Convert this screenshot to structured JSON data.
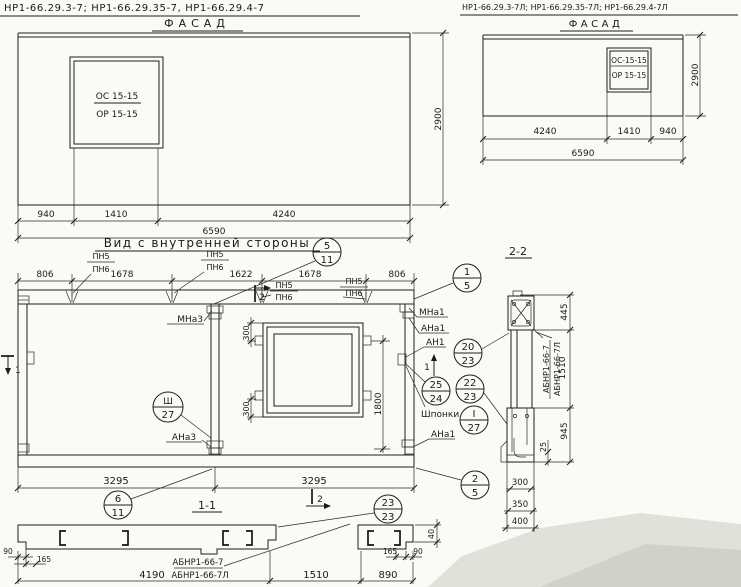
{
  "headers": {
    "left": "НР1-66.29.3-7;  НР1-66.29.35-7,  НР1-66.29.4-7",
    "right": "НР1-66.29.3-7Л; НР1-66.29.35-7Л; НР1-66.29.4-7Л"
  },
  "facade_left": {
    "title": "ФАСАД",
    "window": {
      "line1": "ОС 15-15",
      "line2": "ОР 15-15"
    },
    "dims": {
      "a": "940",
      "b": "1410",
      "c": "4240",
      "total": "6590",
      "height": "2900"
    }
  },
  "facade_right": {
    "title": "ФАСАД",
    "window": {
      "line1": "ОС-15-15",
      "line2": "ОР 15-15"
    },
    "dims": {
      "a": "4240",
      "b": "1410",
      "c": "940",
      "total": "6590",
      "height": "2900"
    }
  },
  "inner_view": {
    "title": "Вид с внутренней стороны",
    "top_dims": {
      "d1": "806",
      "d2": "1678",
      "d3": "1622",
      "d4": "1678",
      "d5": "806"
    },
    "pn": {
      "top": "ПН5",
      "bottom": "ПН6"
    },
    "labels": {
      "mna3": "МНа3",
      "mna1": "МНа1",
      "ana1": "АНа1",
      "an1": "АН1",
      "shponki": "Шпонки",
      "ana3": "АНа3",
      "ana1_bottom": "АНа1"
    },
    "window_dims": {
      "top": "300",
      "bottom": "300",
      "height": "1800"
    },
    "bottom_dims": {
      "left": "3295",
      "right": "3295"
    },
    "marks": {
      "m1": "1",
      "m2": "2"
    },
    "section_title": "1-1"
  },
  "callouts": {
    "c5_11": {
      "top": "5",
      "bottom": "11"
    },
    "c1_5": {
      "top": "1",
      "bottom": "5"
    },
    "c3_27": {
      "top": "Ш",
      "bottom": "27"
    },
    "c20_23": {
      "top": "20",
      "bottom": "23"
    },
    "c25_24": {
      "top": "25",
      "bottom": "24"
    },
    "c22_23": {
      "top": "22",
      "bottom": "23"
    },
    "cI_27": {
      "top": "I",
      "bottom": "27"
    },
    "c6_11": {
      "top": "6",
      "bottom": "11"
    },
    "c2_5": {
      "top": "2",
      "bottom": "5"
    },
    "c23_23": {
      "top": "23",
      "bottom": "23"
    }
  },
  "section22": {
    "title": "2-2",
    "labels": {
      "mark": "АБНР1-66-7",
      "markL": "АБНР1-66-7Л"
    },
    "dims": {
      "d445": "445",
      "d1510": "1510",
      "d25": "25",
      "d945": "945",
      "d300": "300",
      "d350": "350",
      "d400": "400"
    }
  },
  "section11": {
    "labels": {
      "mark": "АБНР1-66-7",
      "markL": "АБНР1-66-7Л"
    },
    "dims": {
      "d90l": "90",
      "d165l": "165",
      "d4190": "4190",
      "d1510": "1510",
      "d890": "890",
      "d165r": "165",
      "d90r": "90",
      "d40": "40"
    }
  }
}
